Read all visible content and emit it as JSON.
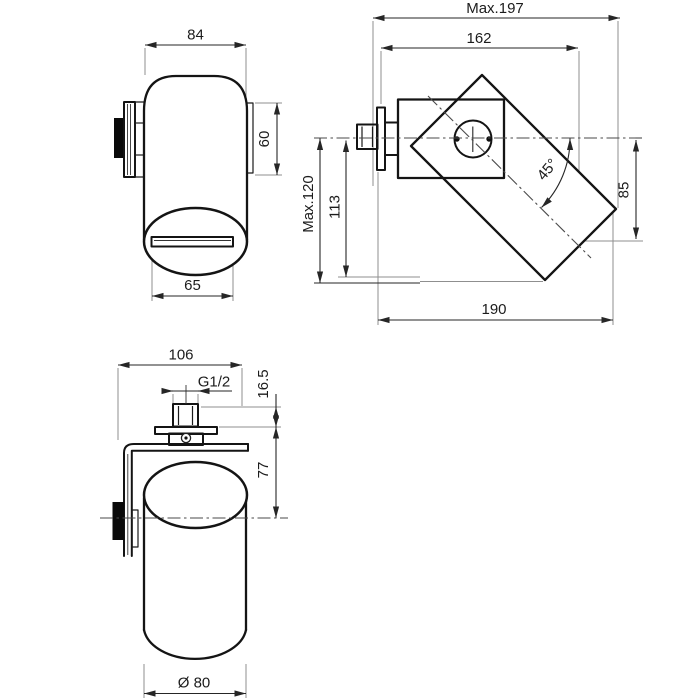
{
  "drawing": {
    "front_view": {
      "width": "84",
      "flange_height": "60",
      "slot_width": "65"
    },
    "side_view": {
      "max_reach": "Max.197",
      "reach": "162",
      "max_drop": "Max.120",
      "drop": "113",
      "swivel_angle": "45°",
      "outlet_offset": "85",
      "depth": "190"
    },
    "top_view": {
      "width": "106",
      "thread": "G1/2",
      "inlet_offset": "16.5",
      "wall_to_axis": "77",
      "diameter": "Ø 80"
    }
  }
}
